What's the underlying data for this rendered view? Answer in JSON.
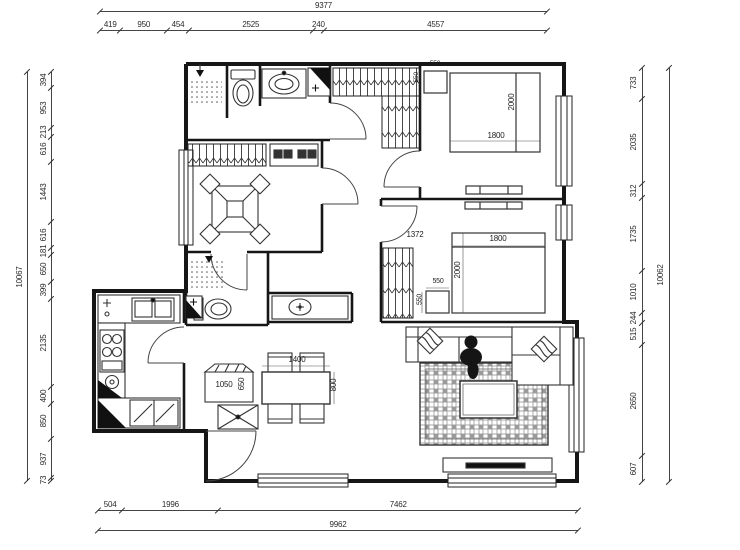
{
  "dimensions": {
    "top": {
      "total": 9377,
      "segments": [
        419,
        950,
        454,
        2525,
        240,
        4557
      ]
    },
    "bottom": {
      "total": 9962,
      "segments": [
        504,
        1996,
        7462
      ]
    },
    "left": {
      "total": 10067,
      "segments": [
        394,
        953,
        213,
        616,
        1443,
        616,
        181,
        650,
        399,
        2135,
        400,
        850,
        937,
        73
      ]
    },
    "right": {
      "total": 10062,
      "segments": [
        733,
        2035,
        312,
        1735,
        1010,
        244,
        515,
        2650,
        607
      ]
    }
  },
  "furniture_labels": {
    "master_bed_width": "1800",
    "master_bed_length": "2000",
    "master_nightstand_w": "550",
    "master_nightstand_d": "550",
    "second_room_span": "1372",
    "second_bed_width": "1800",
    "second_bed_length": "2000",
    "second_nightstand_w": "550",
    "second_nightstand_d": "550",
    "dining_table_length": "1400",
    "dining_table_width": "800",
    "sideboard_length": "1050",
    "sideboard_width": "650"
  },
  "colors": {
    "wall": "#161616",
    "dim_text": "#2a2a2a",
    "background": "#ffffff"
  }
}
